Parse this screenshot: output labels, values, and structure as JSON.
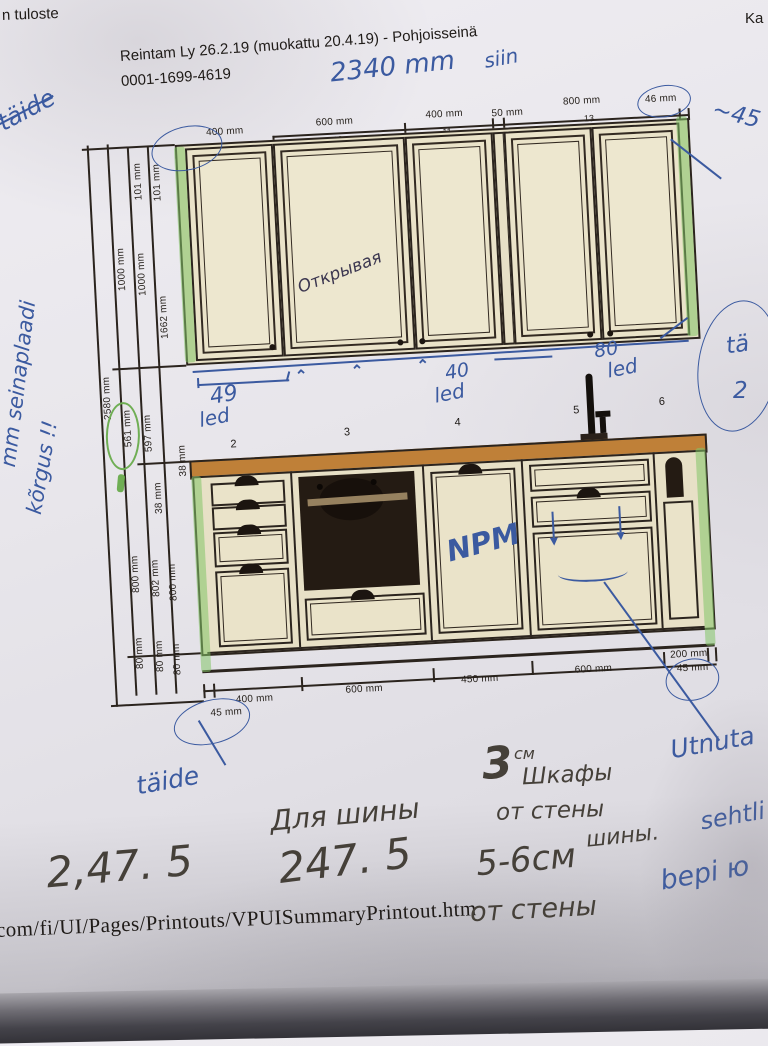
{
  "header": {
    "top_left_partial": "n tuloste",
    "top_right_partial": "Ka",
    "title": "Reintam Ly 26.2.19 (muokattu 20.4.19) - Pohjoisseinä",
    "order_number": "0001-1699-4619"
  },
  "footer": {
    "url": "com/fi/UI/Pages/Printouts/VPUISummaryPrintout.htm"
  },
  "dimensions": {
    "top": [
      {
        "label": "45 mm"
      },
      {
        "label": "400 mm",
        "item": "9"
      },
      {
        "label": "600 mm",
        "item": "10"
      },
      {
        "label": "400 mm",
        "item": "11"
      },
      {
        "label": "50 mm"
      },
      {
        "label": "800 mm",
        "item": "13"
      },
      {
        "label": "46 mm"
      }
    ],
    "left": {
      "total": "2580 mm",
      "upper": [
        "101 mm",
        "101 mm",
        "1000 mm",
        "1000 mm",
        "1662 mm"
      ],
      "middle": [
        "561 mm",
        "597 mm",
        "38 mm",
        "38 mm"
      ],
      "lower": [
        "800 mm",
        "802 mm",
        "800 mm",
        "80 mm",
        "80 mm",
        "80 mm"
      ]
    },
    "bottom": [
      "45 mm",
      "400 mm",
      "600 mm",
      "450 mm",
      "600 mm",
      "200 mm",
      "45 mm"
    ]
  },
  "cabinet_numbers": {
    "base": [
      "2",
      "3",
      "4",
      "5",
      "6"
    ]
  },
  "handwritten": {
    "top_width_note": "2340 mm",
    "top_width_suffix": "siin",
    "taide_crossed": "täide",
    "left_margin_line1": "mm seinaplaadi",
    "left_margin_line2": "kõrgus !!",
    "approx_45": "~45",
    "led_notes": [
      {
        "value": "49",
        "unit": "led"
      },
      {
        "value": "40",
        "unit": "led"
      },
      {
        "value": "80",
        "unit": "led"
      }
    ],
    "door_scribble": "Открывая",
    "npm": "NPM",
    "right_circle_line1": "tä",
    "right_circle_line2": "2",
    "taide_bottom": "täide",
    "dlya_shiny": "Для шины",
    "three": "3",
    "cm": "см",
    "shkafy": "Шкафы",
    "ot_steny_1": "от стены",
    "utnuta": "Utnuta",
    "sehtli": "sehtli",
    "pencil_left": "2,47. 5",
    "pencil_mid": "247. 5",
    "five_six_cm": "5-6см",
    "shiny": "шины.",
    "ot_steny_2": "от стены",
    "bepi": "bepi ю"
  },
  "colors": {
    "pen_blue": "#3b5aa0",
    "pencil_gray": "#454039",
    "highlighter_green": "#84c468",
    "green_pen": "#6fae54",
    "cabinet_cream": "#eae3c9",
    "countertop_orange": "#bf8038",
    "oven_black": "#241b13",
    "print_black": "#241f1a"
  }
}
